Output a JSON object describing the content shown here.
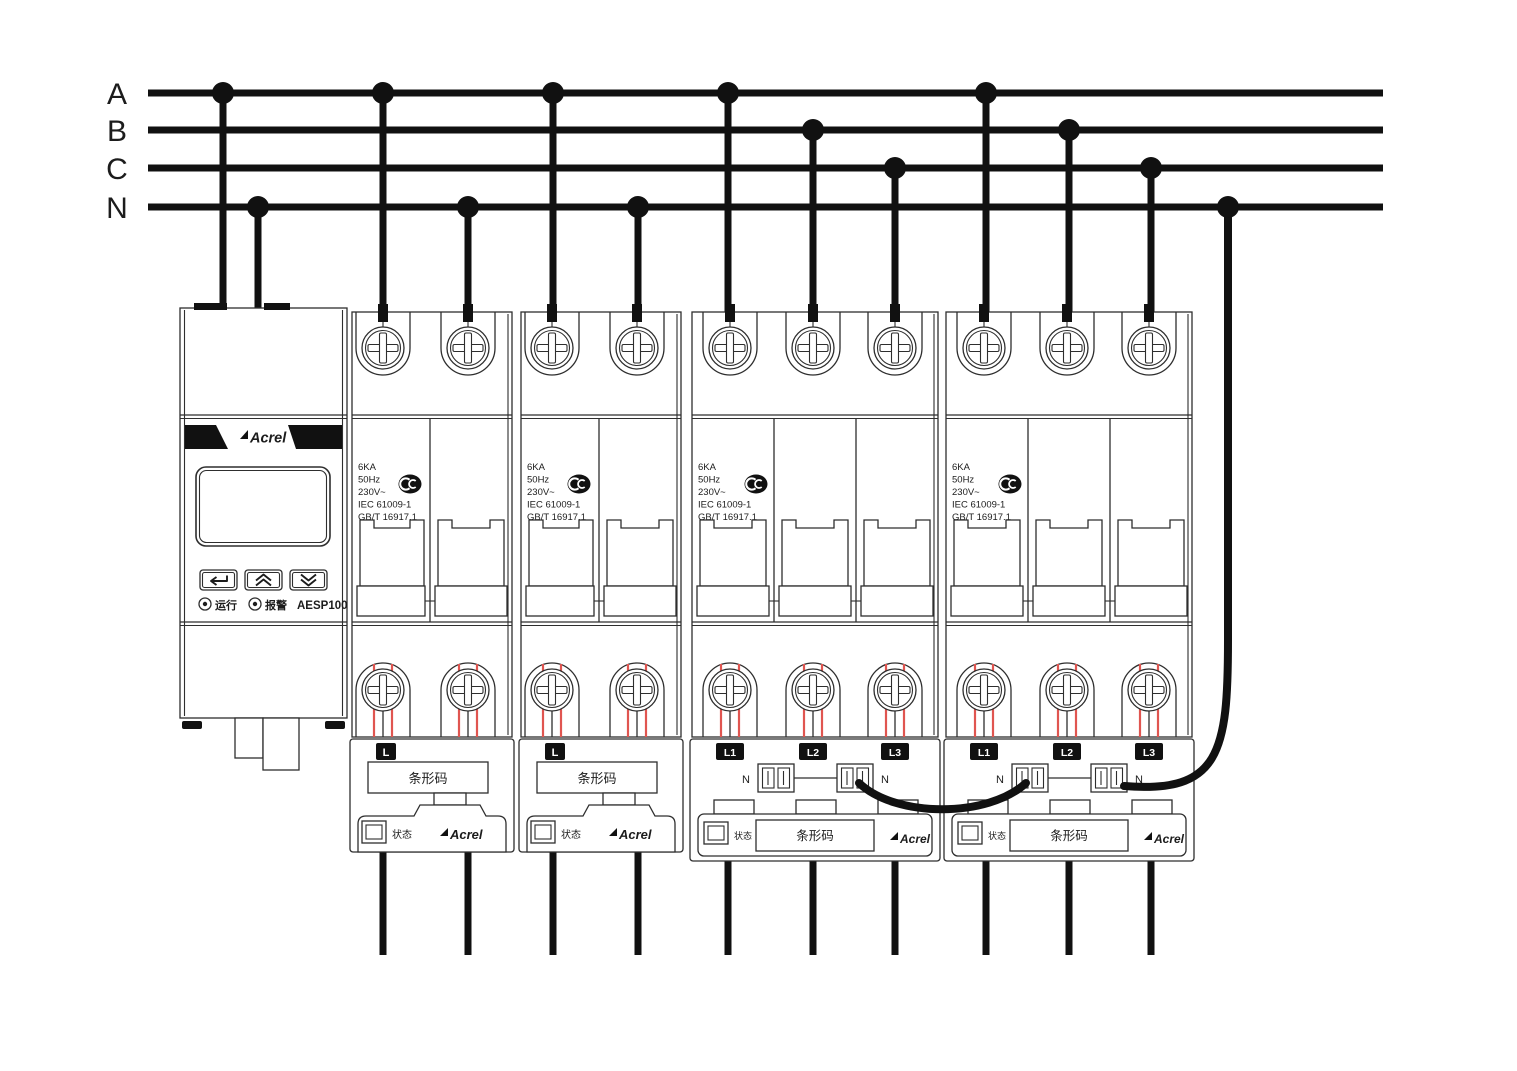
{
  "bus": {
    "labels": [
      "A",
      "B",
      "C",
      "N"
    ]
  },
  "controller": {
    "brand": "Acrel",
    "model": "AESP100",
    "led_run": "运行",
    "led_alarm": "报警"
  },
  "breaker": {
    "spec_lines": [
      "6KA",
      "50Hz",
      "230V~",
      "IEC 61009-1",
      "GB/T 16917.1"
    ]
  },
  "module_single": {
    "pole_label": "L",
    "barcode": "条形码",
    "status": "状态",
    "brand": "Acrel"
  },
  "module_three": {
    "pole_labels": [
      "L1",
      "L2",
      "L3"
    ],
    "n_left": "N",
    "n_right": "N",
    "barcode": "条形码",
    "status": "状态",
    "brand": "Acrel"
  },
  "connections": {
    "controller_phases": [
      "A",
      "N"
    ],
    "breaker1_phases": [
      "A",
      "N"
    ],
    "breaker2_phases": [
      "A",
      "N"
    ],
    "breaker3_phases": [
      "A",
      "B",
      "C"
    ],
    "breaker4_phases": [
      "A",
      "B",
      "C"
    ],
    "neutral_link": "N bus to breaker4 module N terminal, jumper to breaker3 module N terminal"
  },
  "colors": {
    "wire": "#111111",
    "outline": "#2e2e2e",
    "guide_red": "#e05550",
    "label_bg": "#111111"
  }
}
